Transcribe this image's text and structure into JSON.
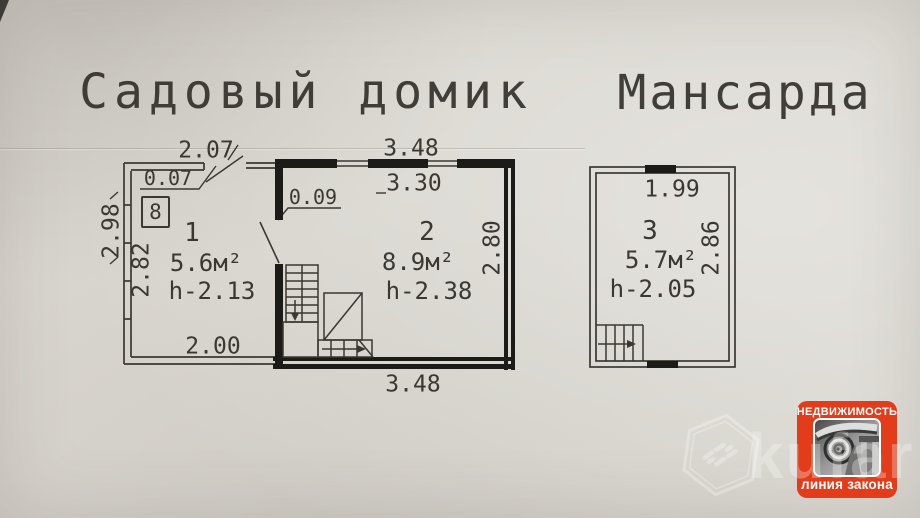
{
  "plan_floor1": {
    "title": "Садовый домик",
    "dim_top_room1": "2.07",
    "dim_wall_thin": "0.07",
    "dim_wall_thick": "0.09",
    "dim_top_room2": "3.48",
    "dim_top_room2_inner": "3.30",
    "dim_left_outer": "2.98",
    "dim_left_inner": "2.82",
    "dim_right_inner": "2.80",
    "dim_bottom_room1": "2.00",
    "dim_bottom_room2": "3.48",
    "room1": {
      "number": "1",
      "area": "5.6м²",
      "height": "h-2.13"
    },
    "room2": {
      "number": "2",
      "area": "8.9м²",
      "height": "h-2.38"
    },
    "stove_label": "8"
  },
  "plan_attic": {
    "title": "Мансарда",
    "dim_top": "1.99",
    "dim_right": "2.86",
    "room3": {
      "number": "3",
      "area": "5.7м²",
      "height": "h-2.05"
    }
  },
  "badge": {
    "line1": "НЕДВИЖИМОСТЬ",
    "line2": "линия закона",
    "bg_color": "#e33c1b"
  },
  "watermark": {
    "brand": "kufar"
  },
  "colors": {
    "paper": "#d9d6cf",
    "ink": "#3b3733",
    "wall": "#1d1b18"
  }
}
